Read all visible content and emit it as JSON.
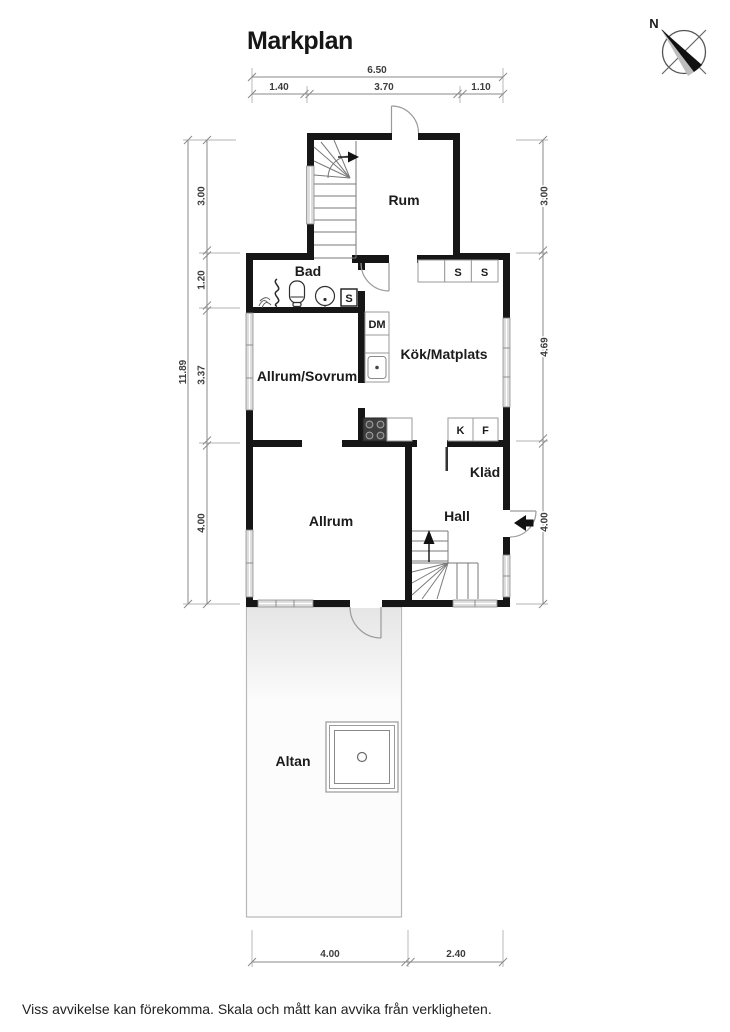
{
  "title": "Markplan",
  "compass": {
    "north_label": "N"
  },
  "rooms": {
    "rum": {
      "label": "Rum"
    },
    "bad": {
      "label": "Bad"
    },
    "kok_matplats": {
      "label": "Kök/Matplats"
    },
    "allrum_sovrum": {
      "label": "Allrum/Sovrum"
    },
    "allrum": {
      "label": "Allrum"
    },
    "hall": {
      "label": "Hall"
    },
    "klad": {
      "label": "Kläd"
    },
    "altan": {
      "label": "Altan"
    }
  },
  "appliances": {
    "bathroom_cabinet": "S",
    "kitchen_cabinet_1": "S",
    "kitchen_cabinet_2": "S",
    "dishwasher": "DM",
    "fridge": "K",
    "freezer": "F"
  },
  "dimensions": {
    "top": {
      "total": "6.50",
      "segments": [
        "1.40",
        "3.70",
        "1.10"
      ]
    },
    "left": {
      "total": "11.89",
      "segments": [
        "3.00",
        "1.20",
        "3.37",
        "4.00"
      ]
    },
    "right": {
      "segments": [
        "3.00",
        "4.69",
        "4.00"
      ]
    },
    "bottom": {
      "segments": [
        "4.00",
        "2.40"
      ]
    }
  },
  "footer": {
    "disclaimer": "Viss avvikelse kan förekomma. Skala och mått kan avvika från verkligheten."
  },
  "colors": {
    "wall": "#161616",
    "window": "#dcdcdc",
    "dimension_line": "#8a8a8a",
    "stair_line": "#7a7a7a"
  }
}
